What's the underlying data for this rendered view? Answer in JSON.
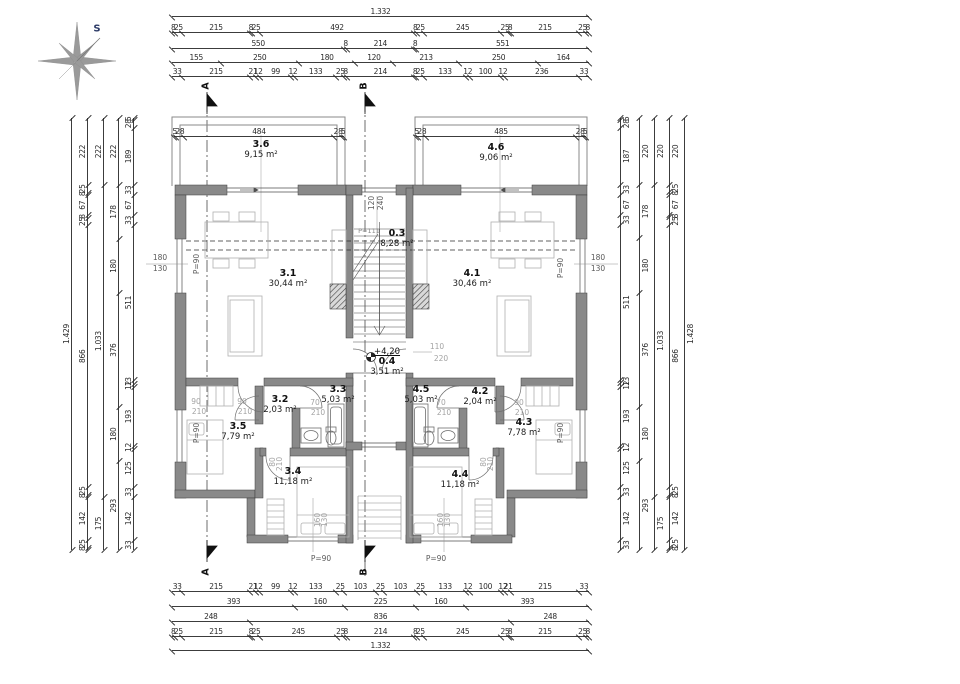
{
  "compass": {
    "north_label": "S"
  },
  "section_markers": {
    "top_a": "A",
    "top_b": "B",
    "bottom_a": "A",
    "bottom_b": "B"
  },
  "rooms": {
    "r36": {
      "id": "3.6",
      "area": "9,15 m²"
    },
    "r46": {
      "id": "4.6",
      "area": "9,06 m²"
    },
    "r03": {
      "id": "0.3",
      "area": "8,28 m²"
    },
    "r31": {
      "id": "3.1",
      "area": "30,44 m²"
    },
    "r41": {
      "id": "4.1",
      "area": "30,46 m²"
    },
    "r04": {
      "id": "0.4",
      "area": "3,51 m²",
      "level": "+4,20"
    },
    "r32": {
      "id": "3.2",
      "area": "2,03 m²"
    },
    "r33": {
      "id": "3.3",
      "area": "5,03 m²"
    },
    "r45": {
      "id": "4.5",
      "area": "5,03 m²"
    },
    "r42": {
      "id": "4.2",
      "area": "2,04 m²"
    },
    "r35": {
      "id": "3.5",
      "area": "7,79 m²"
    },
    "r43": {
      "id": "4.3",
      "area": "7,78 m²"
    },
    "r34": {
      "id": "3.4",
      "area": "11,18 m²"
    },
    "r44": {
      "id": "4.4",
      "area": "11,18 m²"
    }
  },
  "dimensions": {
    "top": [
      [
        "1.332"
      ],
      [
        "8",
        "25",
        "215",
        "8",
        "25",
        "492",
        "8",
        "25",
        "245",
        "25",
        "8",
        "215",
        "25",
        "8"
      ],
      [
        "550",
        "8",
        "214",
        "8",
        "551"
      ],
      [
        "155",
        "250",
        "180",
        "120",
        "213",
        "250",
        "164"
      ],
      [
        "33",
        "215",
        "21",
        "12",
        "99",
        "12",
        "133",
        "25",
        "8",
        "214",
        "8",
        "25",
        "133",
        "12",
        "100",
        "12",
        "236",
        "33"
      ]
    ],
    "bottom": [
      [
        "33",
        "215",
        "21",
        "12",
        "99",
        "12",
        "133",
        "25",
        "103",
        "25",
        "103",
        "25",
        "133",
        "12",
        "100",
        "12",
        "21",
        "215",
        "33"
      ],
      [
        "393",
        "160",
        "225",
        "160",
        "393"
      ],
      [
        "248",
        "836",
        "248"
      ],
      [
        "8",
        "25",
        "215",
        "8",
        "25",
        "245",
        "25",
        "8",
        "214",
        "8",
        "25",
        "245",
        "25",
        "8",
        "215",
        "25",
        "8"
      ],
      [
        "1.332"
      ]
    ],
    "left": [
      [
        "1.429"
      ],
      [
        "222",
        "25",
        "8",
        "67",
        "8",
        "25",
        "866",
        "25",
        "8",
        "142",
        "25",
        "8"
      ],
      [
        "222",
        "1.033",
        "175"
      ],
      [
        "222",
        "178",
        "180",
        "376",
        "180",
        "293"
      ],
      [
        "5",
        "28",
        "189",
        "33",
        "67",
        "33",
        "511",
        "13",
        "12",
        "193",
        "12",
        "125",
        "33",
        "142",
        "33"
      ]
    ],
    "right": [
      [
        "5",
        "28",
        "187",
        "33",
        "67",
        "33",
        "511",
        "13",
        "12",
        "193",
        "12",
        "125",
        "33",
        "142",
        "33"
      ],
      [
        "220",
        "178",
        "180",
        "376",
        "180",
        "293"
      ],
      [
        "220",
        "1.033",
        "175"
      ],
      [
        "220",
        "25",
        "8",
        "67",
        "8",
        "25",
        "866",
        "25",
        "8",
        "142",
        "25",
        "8"
      ],
      [
        "1.428"
      ]
    ],
    "terrace_left": [
      "5",
      "28",
      "484",
      "28",
      "5"
    ],
    "terrace_right": [
      "5",
      "28",
      "485",
      "28",
      "5"
    ]
  },
  "annotations": {
    "p90": "P=90",
    "p111": "P=111",
    "window_side": {
      "w": "180",
      "h": "130"
    },
    "window_stair": {
      "w": "120",
      "h": "240"
    },
    "door_entry": {
      "w": "110",
      "h": "220"
    },
    "window_bottom": {
      "w": "160",
      "h": "130"
    },
    "door_90": "90",
    "door_70": "70",
    "door_80": "80",
    "door_h": "210"
  }
}
